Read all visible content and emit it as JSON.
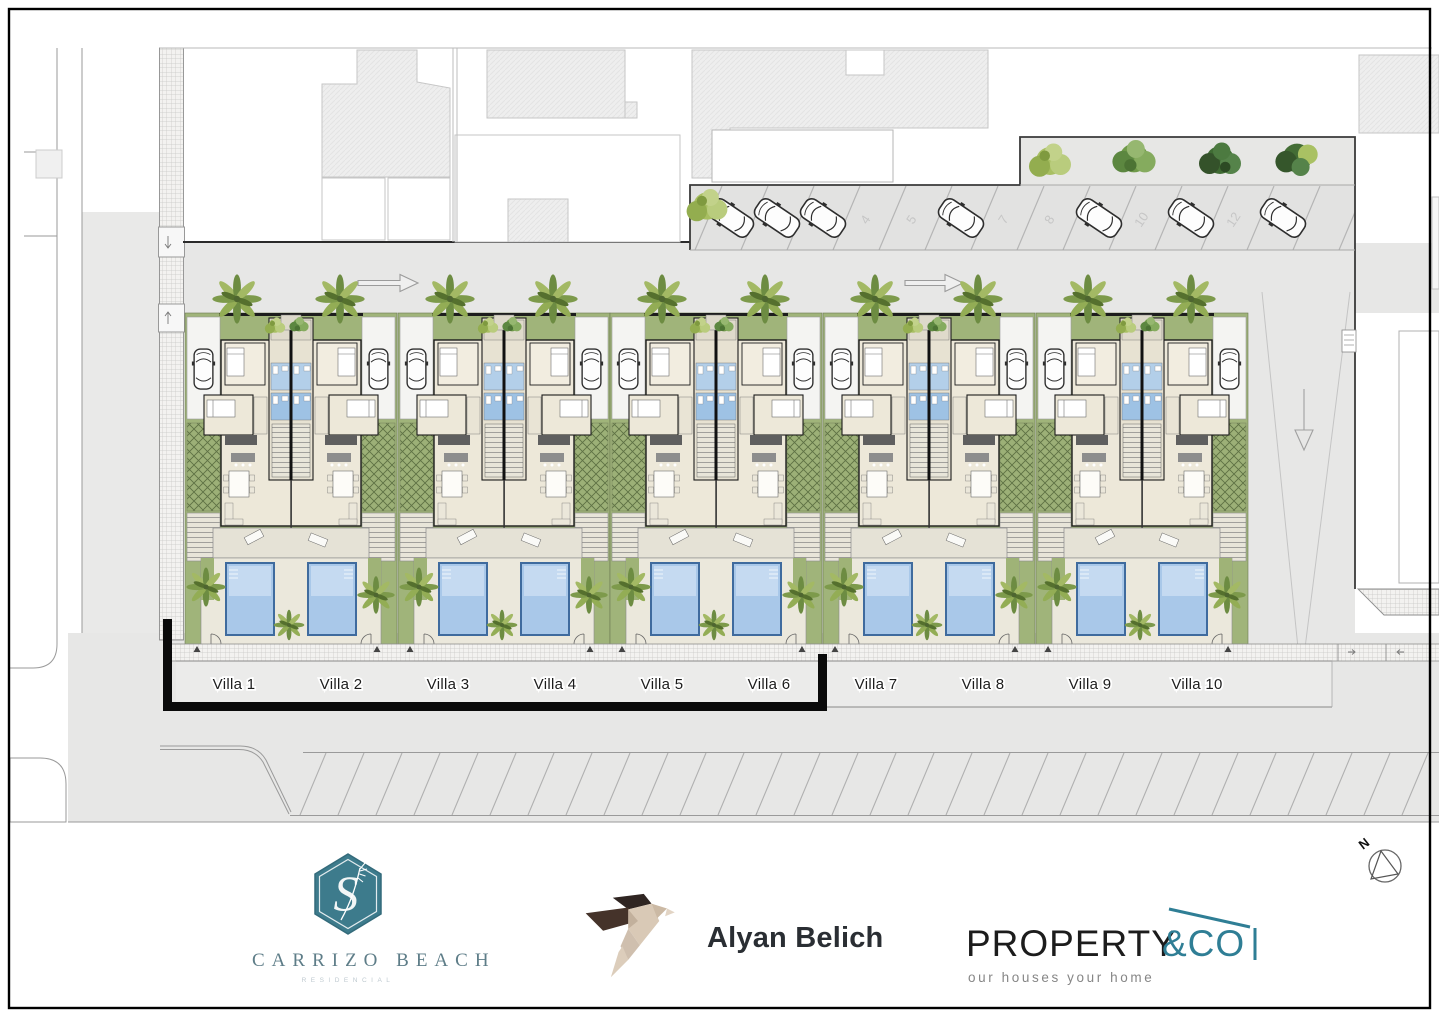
{
  "plan": {
    "villa_labels": [
      "Villa 1",
      "Villa 2",
      "Villa 3",
      "Villa 4",
      "Villa 5",
      "Villa 6",
      "Villa 7",
      "Villa 8",
      "Villa 9",
      "Villa 10"
    ],
    "parking_space_numbers": [
      "4",
      "5",
      "7",
      "8",
      "10",
      "12"
    ],
    "north_label": "N"
  },
  "branding": {
    "carrizo": {
      "monogram": "S",
      "name": "CARRIZO BEACH",
      "subtitle": "RESIDENCIAL"
    },
    "alyan": {
      "name": "Alyan Belich"
    },
    "property": {
      "name_primary": "PROPERTY",
      "name_accent": "&CO",
      "tagline": "our houses your home"
    }
  },
  "colors": {
    "carrizo_teal": "#3d7b8c",
    "property_teal": "#2f7e95",
    "alyan_dark_brown": "#352a23",
    "alyan_beige": "#d9c9b6",
    "landscape_green": "#a0b47a",
    "pool_blue": "#a9c8e9"
  }
}
